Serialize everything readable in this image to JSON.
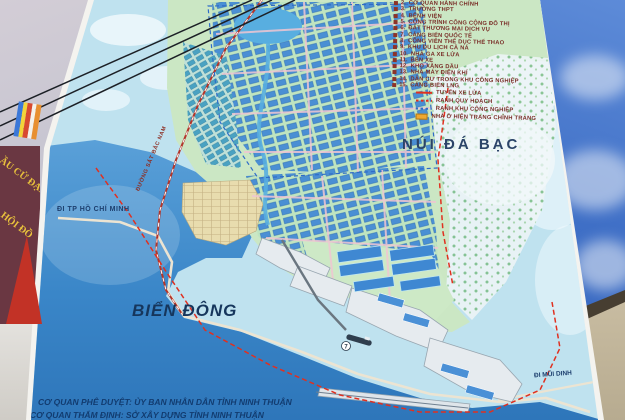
{
  "scene": {
    "sky_left_color": "#c9c3cf",
    "sky_right_color": "#3f6fc6",
    "building_color": "#cfc3a8"
  },
  "surroundings": {
    "banner": {
      "color": "#6a3742",
      "text_color": "#e9c23c",
      "fragment1": "ẦU CỬ ĐẠI BI",
      "fragment2": "HỘI ĐỒ"
    },
    "red_flag_color": "#c23226",
    "wire_flag_colors": [
      "#3a78d8",
      "#f2d439",
      "#d84a30",
      "#f5f2ea",
      "#e89030"
    ]
  },
  "billboard": {
    "frame_color": "#f4f3ef",
    "map": {
      "sea_color": "#3a86c8",
      "land_color": "#cbe7c4",
      "block_color": "#4a8fd4",
      "boundary_red": "#e03020",
      "boundary_blue": "#2f6cc8",
      "labels": {
        "mountain": "NÚI ĐÁ BẠC",
        "sea": "BIỂN ĐÔNG",
        "road_left": "ĐI TP HỒ CHÍ MINH",
        "road_right": "ĐI MŨI DINH",
        "railway": "ĐƯỜNG SẮT BẮC NAM"
      },
      "badge7": "7",
      "footer": {
        "line1": "CƠ QUAN PHÊ DUYỆT: ỦY BAN NHÂN DÂN TỈNH NINH THUẬN",
        "line2": "CƠ QUAN THẨM ĐỊNH: SỞ XÂY DỰNG TỈNH NINH THUẬN"
      }
    },
    "legend": {
      "text_color": "#7a2f28",
      "items": [
        {
          "num": "2.",
          "label": "CƠ QUAN HÀNH CHÍNH"
        },
        {
          "num": "3.",
          "label": "TRƯỜNG THPT"
        },
        {
          "num": "4.",
          "label": "BỆNH VIỆN"
        },
        {
          "num": "5.",
          "label": "CÔNG TRÌNH CÔNG CỘNG ĐÔ THỊ"
        },
        {
          "num": "6.",
          "label": "ĐẤT THƯƠNG MẠI DỊCH VỤ"
        },
        {
          "num": "7.",
          "label": "CẢNG BIỂN QUỐC TẾ"
        },
        {
          "num": "8.",
          "label": "CÔNG VIÊN THỂ DỤC THỂ THAO"
        },
        {
          "num": "9.",
          "label": "KHU DU LỊCH CÀ NÁ"
        },
        {
          "num": "10.",
          "label": "NHÀ GA XE LỬA"
        },
        {
          "num": "11.",
          "label": "BẾN XE"
        },
        {
          "num": "12.",
          "label": "KHO XĂNG DẦU"
        },
        {
          "num": "13.",
          "label": "NHÀ MÁY ĐIỆN KHÍ"
        },
        {
          "num": "14.",
          "label": "DÂN CƯ TRONG KHU CÔNG NGHIỆP"
        },
        {
          "num": "15.",
          "label": "CẢNG BIỂN LNG"
        }
      ],
      "lines": [
        {
          "label": "TUYẾN XE LỬA",
          "style": "solid-red"
        },
        {
          "label": "RANH QUY HOẠCH",
          "style": "dashed-red"
        },
        {
          "label": "RANH KHU CÔNG NGHIỆP",
          "style": "dashed-blue"
        },
        {
          "label": "NHÀ Ở HIỆN TRẠNG CHỈNH TRANG",
          "style": "swatch-orange"
        }
      ]
    }
  }
}
